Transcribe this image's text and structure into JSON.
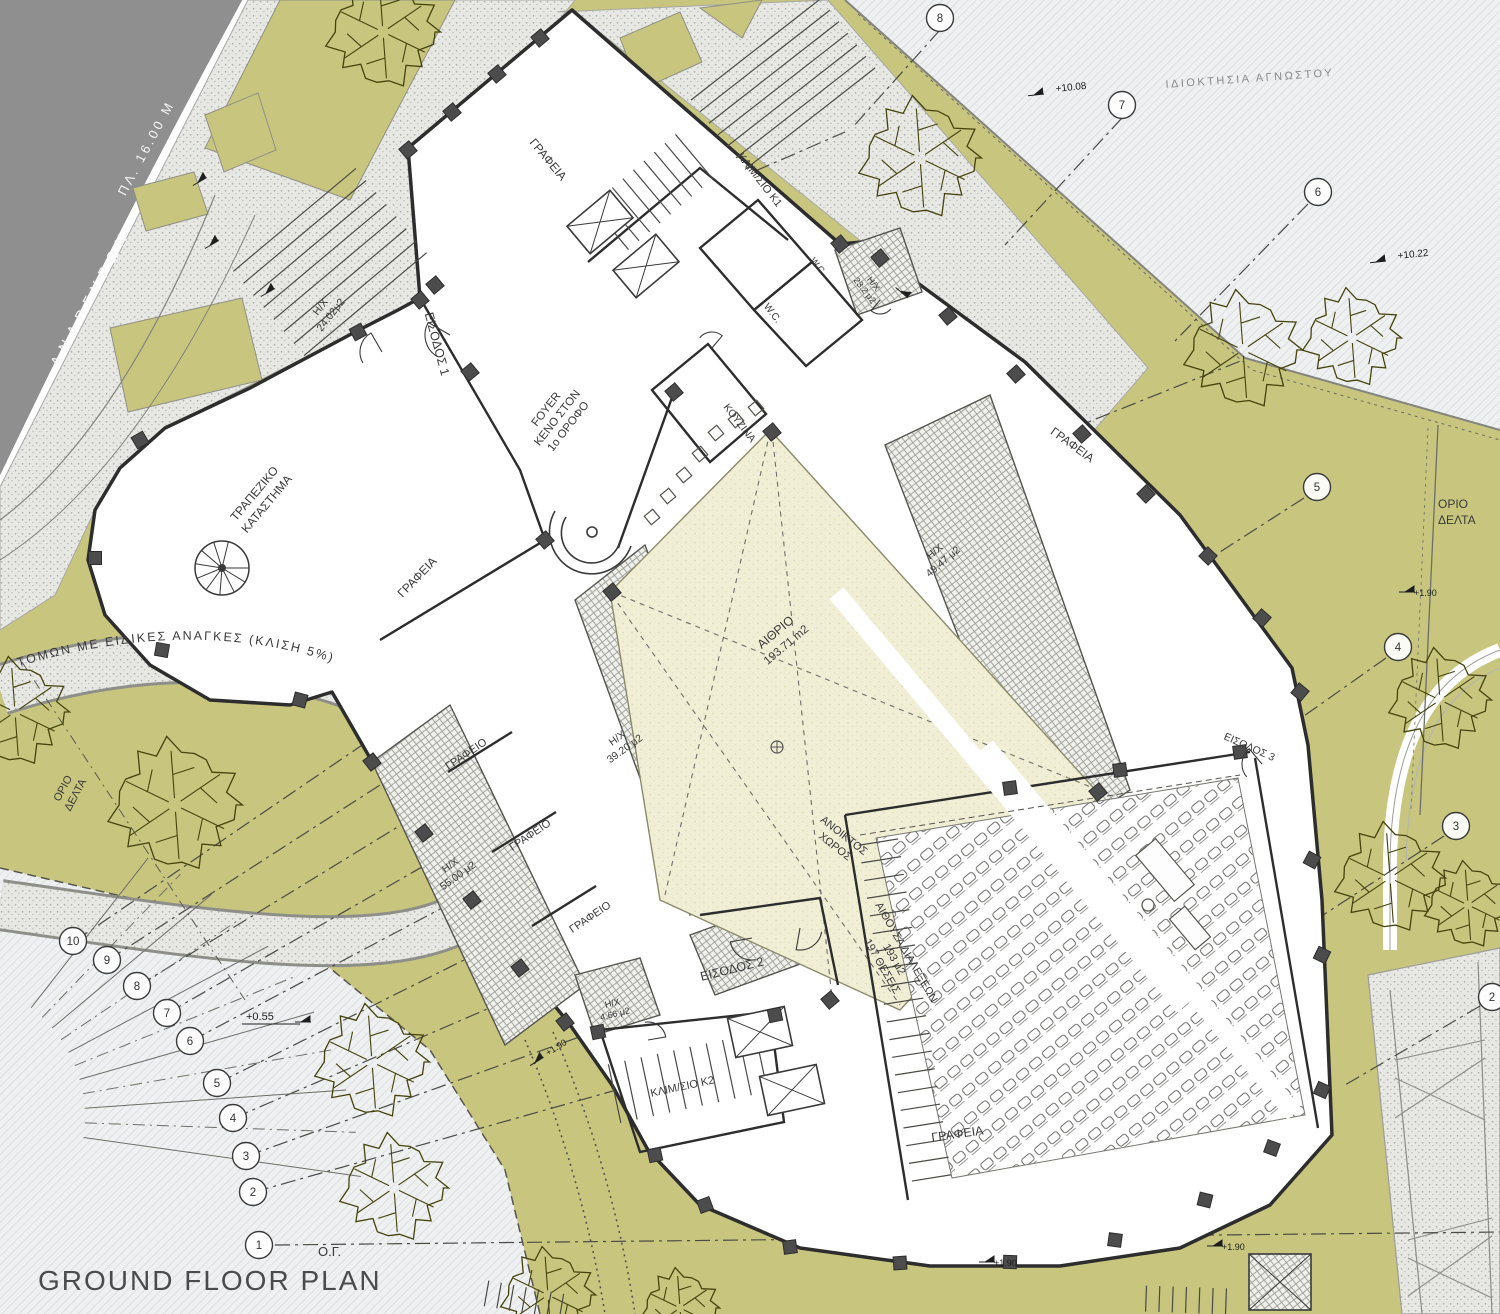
{
  "title": "GROUND FLOOR PLAN",
  "street": {
    "name": "ΑΝΑΡΓΥΡΩΝ",
    "width_label": "ΠΛ. 16.00 Μ"
  },
  "site": {
    "neighbor_property": "ΙΔΙΟΚΤΗΣΙΑ ΑΓΝΩΣΤΟΥ",
    "boundary_l1": "ΟΡΙΟ",
    "boundary_l2": "ΔΕΛΤΑ",
    "building_line": "Ο.Γ.",
    "ramp": "ΤΟΜΩΝ ΜΕ ΕΙΔΙΚΕΣ ΑΝΑΓΚΕΣ (ΚΛΙΣΗ 5%)"
  },
  "entrances": {
    "e1": "ΕΙΣΟΔΟΣ 1",
    "e2": "ΕΙΣΟΔΟΣ 2",
    "e3": "ΕΙΣΟΔΟΣ 3"
  },
  "rooms": {
    "offices": "ΓΡΑΦΕΙΑ",
    "office": "ΓΡΑΦΕΙΟ",
    "bank_l1": "ΤΡΑΠΕΖΙΚΟ",
    "bank_l2": "ΚΑΤΑΣΤΗΜΑ",
    "foyer_l1": "FOYER",
    "foyer_l2": "ΚΕΝΟ ΣΤΟΝ",
    "foyer_l3": "1ο ΟΡΟΦΟ",
    "atrium_l1": "ΑΙΘΡΙΟ",
    "atrium_l2": "193.71 m2",
    "stair_k1": "ΚΛΙΜ/ΣΙΟ Κ1",
    "stair_k2": "ΚΛΙΜ/ΣΙΟ Κ2",
    "kitchen": "ΚΟΥΖΙΝΑ",
    "wc": "W.C.",
    "open_l1": "ΑΝΟΙΚΤΟΣ",
    "open_l2": "ΧΩΡΟΣ",
    "hall_l1": "ΑΙΘΟΥΣΑ ΔΙΑΛΕΞΕΩΝ",
    "hall_l2": "193 μ2",
    "hall_l3": "197 ΘΕΣΕΙΣ"
  },
  "hx": {
    "tag": "Η/Χ",
    "a1": "24.02μ2",
    "a2": "49.47 μ2",
    "a3": "39.20 μ2",
    "a4": "55.00 μ2",
    "a5": "4.66 μ2",
    "a6": "23.2 μ2"
  },
  "levels": {
    "v1008": "+10.08",
    "v1022": "+10.22",
    "v055": "+0.55",
    "v190": "+1.90"
  },
  "grid_left": [
    "10",
    "9",
    "8",
    "7",
    "6",
    "5",
    "4",
    "3",
    "2",
    "1"
  ],
  "grid_right": [
    "8",
    "7",
    "6",
    "5",
    "4",
    "3",
    "2"
  ],
  "colors": {
    "landscape_olive": "#c8c67e",
    "atrium_cream": "#f1eed6",
    "road_gray": "#8f8f8f",
    "paving_gray": "#e7e7e4",
    "hatch_bg": "#eef0f1",
    "wall_dark": "#2d2d2d",
    "tree_ink": "#45430c"
  }
}
